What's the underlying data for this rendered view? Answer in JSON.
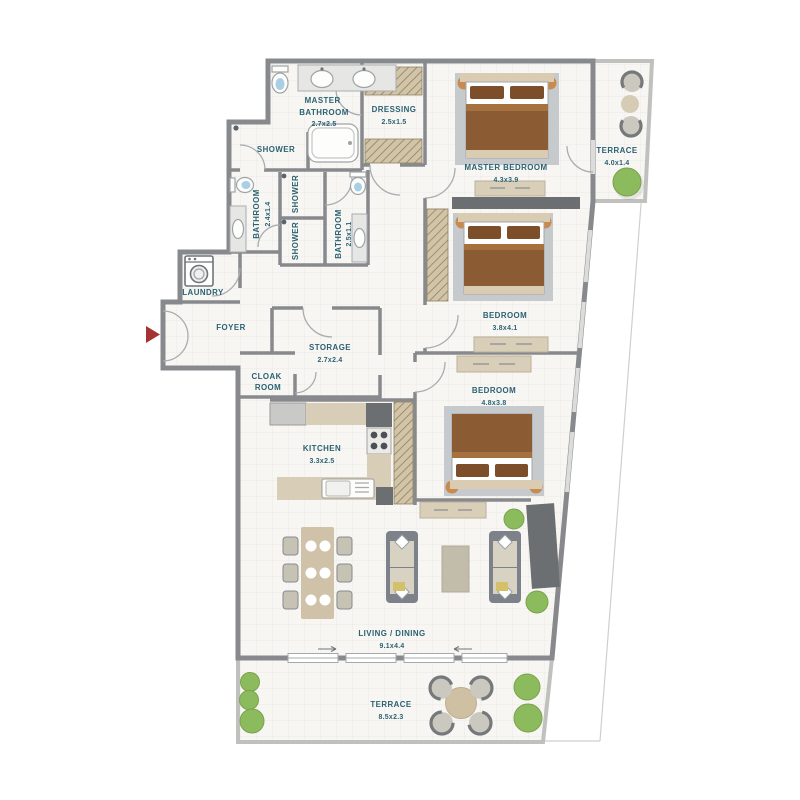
{
  "plan_type": "apartment-floor-plan",
  "rooms": [
    {
      "id": "master-bathroom",
      "line1": "MASTER",
      "line2": "BATHROOM",
      "dims": "2.7x2.5"
    },
    {
      "id": "dressing",
      "name": "DRESSING",
      "dims": "2.5x1.5"
    },
    {
      "id": "shower-top",
      "name": "SHOWER",
      "dims": ""
    },
    {
      "id": "master-bedroom",
      "name": "MASTER BEDROOM",
      "dims": "4.3x3.9"
    },
    {
      "id": "terrace-upper",
      "name": "TERRACE",
      "dims": "4.0x1.4"
    },
    {
      "id": "bathroom-left",
      "name": "BATHROOM",
      "dims": "2.4x1.4"
    },
    {
      "id": "shower-mid-upper",
      "name": "SHOWER",
      "dims": ""
    },
    {
      "id": "shower-mid-lower",
      "name": "SHOWER",
      "dims": ""
    },
    {
      "id": "bathroom-right",
      "name": "BATHROOM",
      "dims": "2.5x1.1"
    },
    {
      "id": "laundry",
      "name": "LAUNDRY",
      "dims": ""
    },
    {
      "id": "foyer",
      "name": "FOYER",
      "dims": ""
    },
    {
      "id": "storage",
      "name": "STORAGE",
      "dims": "2.7x2.4"
    },
    {
      "id": "cloak-room",
      "line1": "CLOAK",
      "line2": "ROOM",
      "dims": ""
    },
    {
      "id": "bedroom-2",
      "name": "BEDROOM",
      "dims": "3.8x4.1"
    },
    {
      "id": "bedroom-3",
      "name": "BEDROOM",
      "dims": "4.8x3.8"
    },
    {
      "id": "kitchen",
      "name": "KITCHEN",
      "dims": "3.3x2.5"
    },
    {
      "id": "living-dining",
      "name": "LIVING / DINING",
      "dims": "9.1x4.4"
    },
    {
      "id": "terrace-lower",
      "name": "TERRACE",
      "dims": "8.5x2.3"
    }
  ],
  "icons": {
    "entry-arrow": "triangle-right",
    "washing-machine": "drum-circle",
    "stove": "four-burners",
    "shower-head": "corner-dot"
  },
  "colors": {
    "wall": "#87898c",
    "wall_dark": "#6b6f72",
    "floor": "#f7f6f3",
    "grid": "#ebe9e4",
    "label_text": "#2b6173",
    "entry_arrow": "#a43431",
    "wood_dark": "#8b5c33",
    "wood_light": "#a5713f",
    "headboard_beige": "#d9ccb2",
    "furniture_beige": "#d9cfb8",
    "rug_gray": "#c6cacd",
    "plant_green": "#8cbb5e",
    "hatch_fill": "#d2c4a6",
    "hatch_line": "#8e8165",
    "railing": "#c0c1bf",
    "window": "#dcdcda",
    "sofa_frame": "#7d818a",
    "cushion": "#d8d2c3",
    "pillow_yellow": "#d5c06a",
    "counter": "#d8cdb6",
    "toilet_seat_blue": "#a9cfe5"
  }
}
